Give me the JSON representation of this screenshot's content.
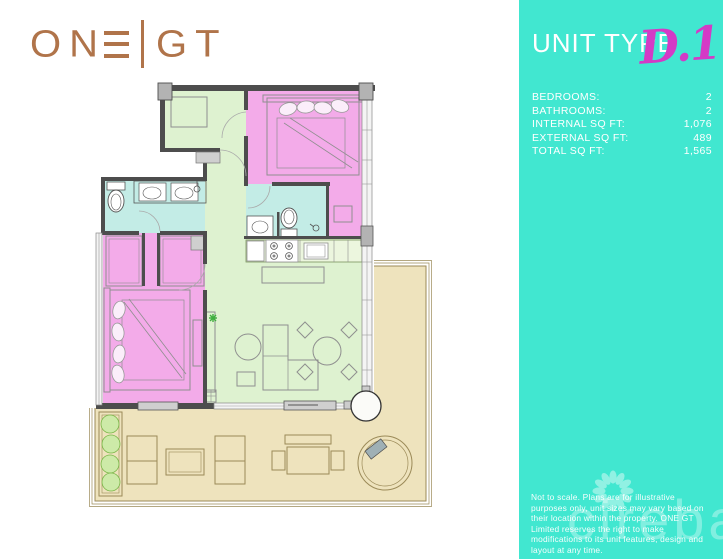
{
  "brand": {
    "logo_text": "ONE|GT",
    "logo_on": "ON",
    "logo_gt": "GT",
    "logo_color": "#b0744a"
  },
  "sidebar": {
    "background_color": "#41e7d0",
    "title": "UNIT TYPE",
    "unit_code": "D.1",
    "unit_code_color": "#d43ac6",
    "specs": [
      {
        "label": "BEDROOMS:",
        "value": "2"
      },
      {
        "label": "BATHROOMS:",
        "value": "2"
      },
      {
        "label": "INTERNAL SQ FT:",
        "value": "1,076"
      },
      {
        "label": "EXTERNAL SQ FT:",
        "value": "489"
      },
      {
        "label": "TOTAL SQ FT:",
        "value": "1,565"
      }
    ],
    "disclaimer": "Not to scale. Plans are for illustrative purposes only, unit sizes may vary based on their location within the property. ONE GT Limited reserves the right to make modifications to its unit features, design and layout at any time.",
    "watermark_text": "cireba"
  },
  "floorplan": {
    "colors": {
      "bedroom": "#f3abe9",
      "bathroom": "#c3ece6",
      "living": "#def2d0",
      "terrace": "#eee3bd",
      "wall": "#4d4d4d",
      "terrace_outline": "#9b8a58"
    }
  }
}
